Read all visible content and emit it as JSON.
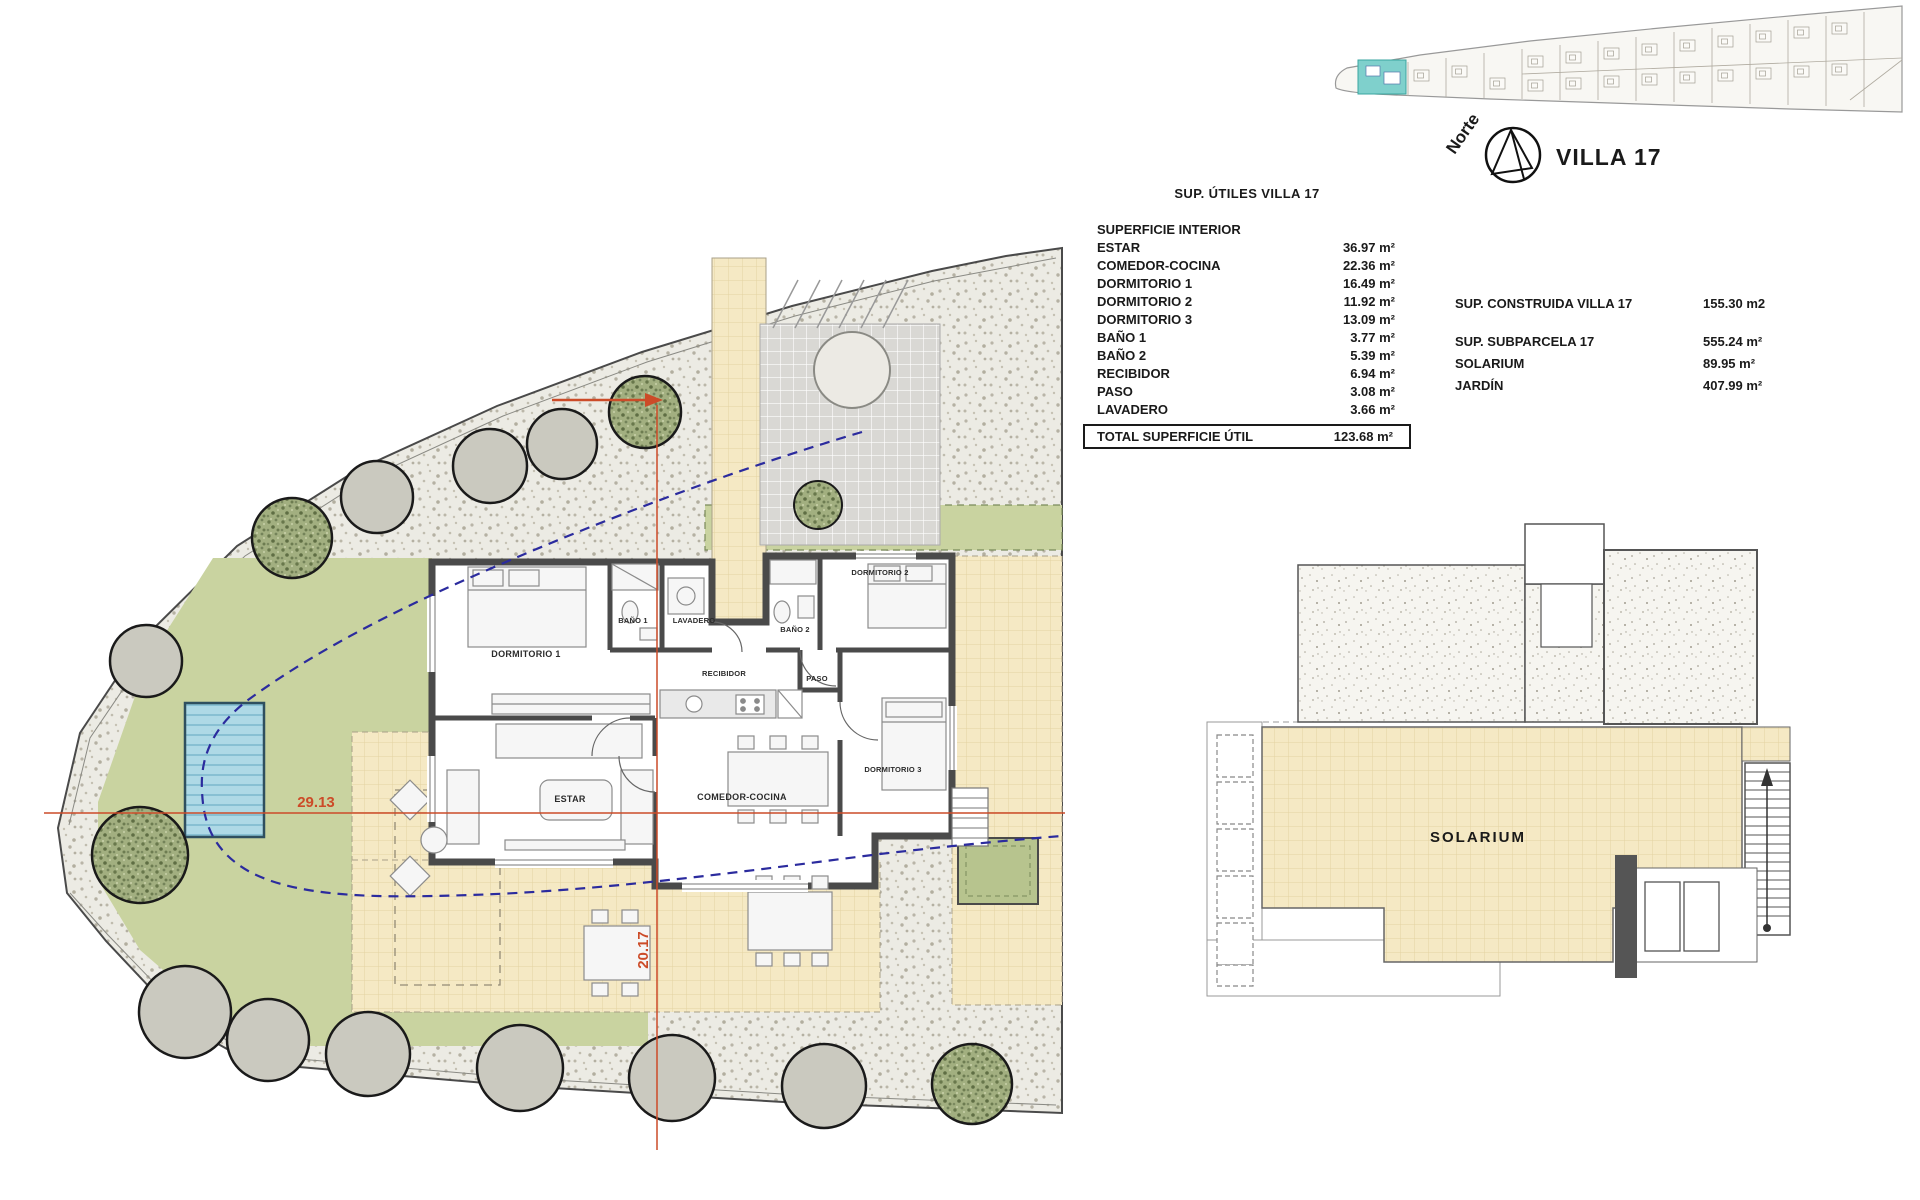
{
  "header": {
    "villa_label": "VILLA 17",
    "north_label": "Norte"
  },
  "areas_table": {
    "title": "SUP. ÚTILES VILLA 17",
    "section": "SUPERFICIE INTERIOR",
    "rows": [
      {
        "label": "ESTAR",
        "value": "36.97 m²"
      },
      {
        "label": "COMEDOR-COCINA",
        "value": "22.36 m²"
      },
      {
        "label": "DORMITORIO 1",
        "value": "16.49 m²"
      },
      {
        "label": "DORMITORIO 2",
        "value": "11.92 m²"
      },
      {
        "label": "DORMITORIO 3",
        "value": "13.09 m²"
      },
      {
        "label": "BAÑO 1",
        "value": "3.77 m²"
      },
      {
        "label": "BAÑO 2",
        "value": "5.39 m²"
      },
      {
        "label": "RECIBIDOR",
        "value": "6.94 m²"
      },
      {
        "label": "PASO",
        "value": "3.08 m²"
      },
      {
        "label": "LAVADERO",
        "value": "3.66 m²"
      }
    ],
    "total_label": "TOTAL SUPERFICIE ÚTIL",
    "total_value": "123.68 m²"
  },
  "summary_table": {
    "rows": [
      {
        "label": "SUP. CONSTRUIDA VILLA 17",
        "value": "155.30 m2"
      },
      {
        "label": "SUP. SUBPARCELA 17",
        "value": "555.24 m²"
      },
      {
        "label": "SOLARIUM",
        "value": "89.95 m²"
      },
      {
        "label": "JARDÍN",
        "value": "407.99 m²"
      }
    ]
  },
  "floor_plan": {
    "rooms": {
      "dormitorio_1": "DORMITORIO 1",
      "bano_1": "BAÑO 1",
      "lavadero": "LAVADERO",
      "recibidor": "RECIBIDOR",
      "bano_2": "BAÑO 2",
      "dormitorio_2": "DORMITORIO 2",
      "paso": "PASO",
      "dormitorio_3": "DORMITORIO 3",
      "estar": "ESTAR",
      "comedor_cocina": "COMEDOR-COCINA"
    },
    "dimensions": {
      "horizontal": "29.13",
      "vertical": "20.17"
    }
  },
  "roof_plan": {
    "label": "SOLARIUM"
  },
  "colors": {
    "garden_green": "#c9d3a0",
    "terrace_yellow": "#f5e9c4",
    "pool_blue": "#aed9e6",
    "wall_gray": "#4a4a4a",
    "dimension_orange": "#cc4b28",
    "setback_blue": "#2b2b9e",
    "locator_highlight": "#7fd0cc"
  }
}
